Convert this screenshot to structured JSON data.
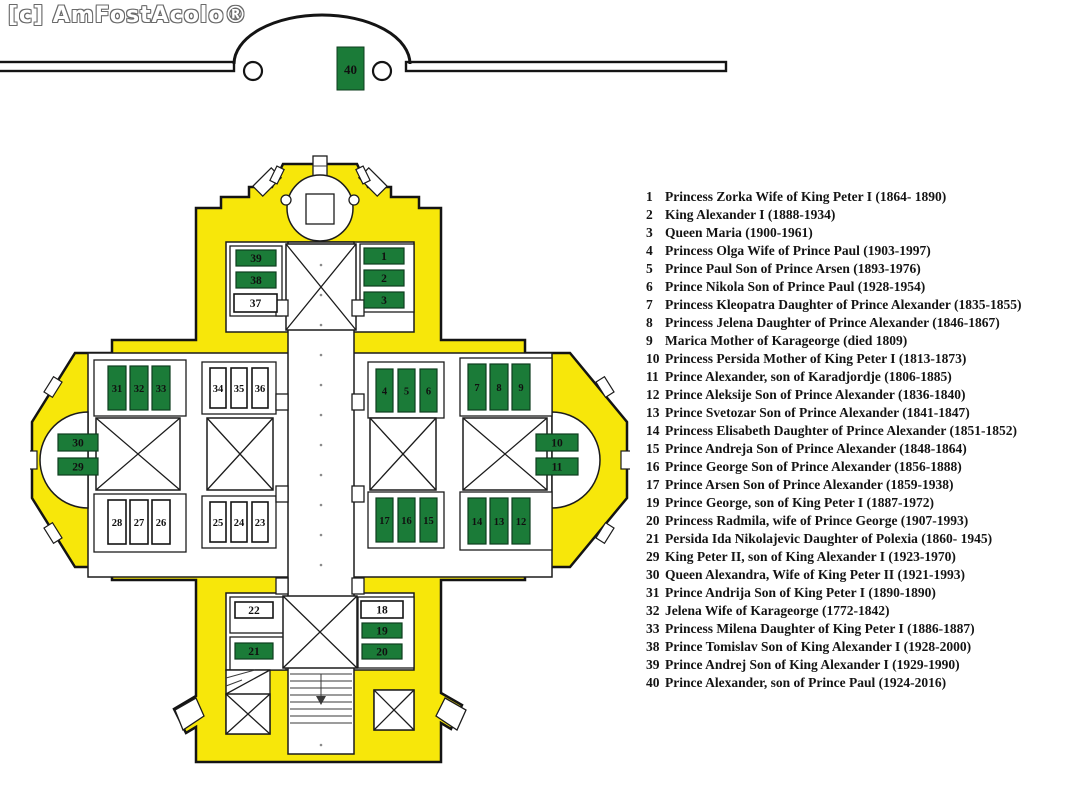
{
  "watermark": {
    "text": "[c] AmFostAcolo®"
  },
  "colors": {
    "wall_yellow": "#f7e70a",
    "highlight_green": "#1b7b38",
    "line": "#141414"
  },
  "crypt": {
    "tomb_label": "40"
  },
  "plan": {
    "tombs": [
      {
        "label": "39",
        "highlighted": true
      },
      {
        "label": "38",
        "highlighted": true
      },
      {
        "label": "37",
        "highlighted": false
      },
      {
        "label": "1",
        "highlighted": true
      },
      {
        "label": "2",
        "highlighted": true
      },
      {
        "label": "3",
        "highlighted": true
      },
      {
        "label": "31",
        "highlighted": true
      },
      {
        "label": "32",
        "highlighted": true
      },
      {
        "label": "33",
        "highlighted": true
      },
      {
        "label": "34",
        "highlighted": false
      },
      {
        "label": "35",
        "highlighted": false
      },
      {
        "label": "36",
        "highlighted": false
      },
      {
        "label": "4",
        "highlighted": true
      },
      {
        "label": "5",
        "highlighted": true
      },
      {
        "label": "6",
        "highlighted": true
      },
      {
        "label": "7",
        "highlighted": true
      },
      {
        "label": "8",
        "highlighted": true
      },
      {
        "label": "9",
        "highlighted": true
      },
      {
        "label": "30",
        "highlighted": true
      },
      {
        "label": "29",
        "highlighted": true
      },
      {
        "label": "10",
        "highlighted": true
      },
      {
        "label": "11",
        "highlighted": true
      },
      {
        "label": "28",
        "highlighted": false
      },
      {
        "label": "27",
        "highlighted": false
      },
      {
        "label": "26",
        "highlighted": false
      },
      {
        "label": "25",
        "highlighted": false
      },
      {
        "label": "24",
        "highlighted": false
      },
      {
        "label": "23",
        "highlighted": false
      },
      {
        "label": "17",
        "highlighted": true
      },
      {
        "label": "16",
        "highlighted": true
      },
      {
        "label": "15",
        "highlighted": true
      },
      {
        "label": "14",
        "highlighted": true
      },
      {
        "label": "13",
        "highlighted": true
      },
      {
        "label": "12",
        "highlighted": true
      },
      {
        "label": "22",
        "highlighted": false
      },
      {
        "label": "21",
        "highlighted": true
      },
      {
        "label": "18",
        "highlighted": false
      },
      {
        "label": "19",
        "highlighted": true
      },
      {
        "label": "20",
        "highlighted": true
      }
    ]
  },
  "legend": {
    "entries": [
      {
        "num": "1",
        "text": "Princess Zorka Wife of King Peter I (1864- 1890)"
      },
      {
        "num": "2",
        "text": "King Alexander I (1888-1934)"
      },
      {
        "num": "3",
        "text": "Queen Maria (1900-1961)"
      },
      {
        "num": "4",
        "text": "Princess Olga Wife of Prince Paul (1903-1997)"
      },
      {
        "num": "5",
        "text": "Prince Paul Son of Prince Arsen (1893-1976)"
      },
      {
        "num": "6",
        "text": "Prince Nikola Son of Prince Paul (1928-1954)"
      },
      {
        "num": "7",
        "text": "Princess Kleopatra Daughter of Prince Alexander (1835-1855)"
      },
      {
        "num": "8",
        "text": "Princess Jelena Daughter of Prince Alexander (1846-1867)"
      },
      {
        "num": "9",
        "text": "Marica Mother of Karageorge (died 1809)"
      },
      {
        "num": "10",
        "text": "Princess Persida Mother of King Peter I (1813-1873)"
      },
      {
        "num": "11",
        "text": "Prince Alexander, son of Karadjordje (1806-1885)"
      },
      {
        "num": "12",
        "text": "Prince Aleksije Son of Prince Alexander (1836-1840)"
      },
      {
        "num": "13",
        "text": "Prince Svetozar Son of Prince Alexander (1841-1847)"
      },
      {
        "num": "14",
        "text": "Princess Elisabeth Daughter of Prince Alexander (1851-1852)"
      },
      {
        "num": "15",
        "text": "Prince Andreja Son of Prince Alexander (1848-1864)"
      },
      {
        "num": "16",
        "text": "Prince George Son of Prince Alexander (1856-1888)"
      },
      {
        "num": "17",
        "text": "Prince Arsen Son of Prince Alexander (1859-1938)"
      },
      {
        "num": "19",
        "text": "Prince George, son of King Peter I (1887-1972)"
      },
      {
        "num": "20",
        "text": "Princess Radmila, wife of Prince George (1907-1993)"
      },
      {
        "num": "21",
        "text": "Persida Ida Nikolajevic Daughter of Polexia (1860- 1945)"
      },
      {
        "num": "29",
        "text": "King Peter II, son of King Alexander I (1923-1970)"
      },
      {
        "num": "30",
        "text": "Queen Alexandra, Wife of King Peter II (1921-1993)"
      },
      {
        "num": "31",
        "text": "Prince Andrija Son of King Peter I (1890-1890)"
      },
      {
        "num": "32",
        "text": "Jelena Wife of Karageorge (1772-1842)"
      },
      {
        "num": "33",
        "text": "Princess Milena Daughter of King Peter I (1886-1887)"
      },
      {
        "num": "38",
        "text": "Prince Tomislav Son of King Alexander I (1928-2000)"
      },
      {
        "num": "39",
        "text": "Prince Andrej Son of King Alexander I (1929-1990)"
      },
      {
        "num": "40",
        "text": "Prince Alexander, son of Prince Paul (1924-2016)"
      }
    ]
  }
}
